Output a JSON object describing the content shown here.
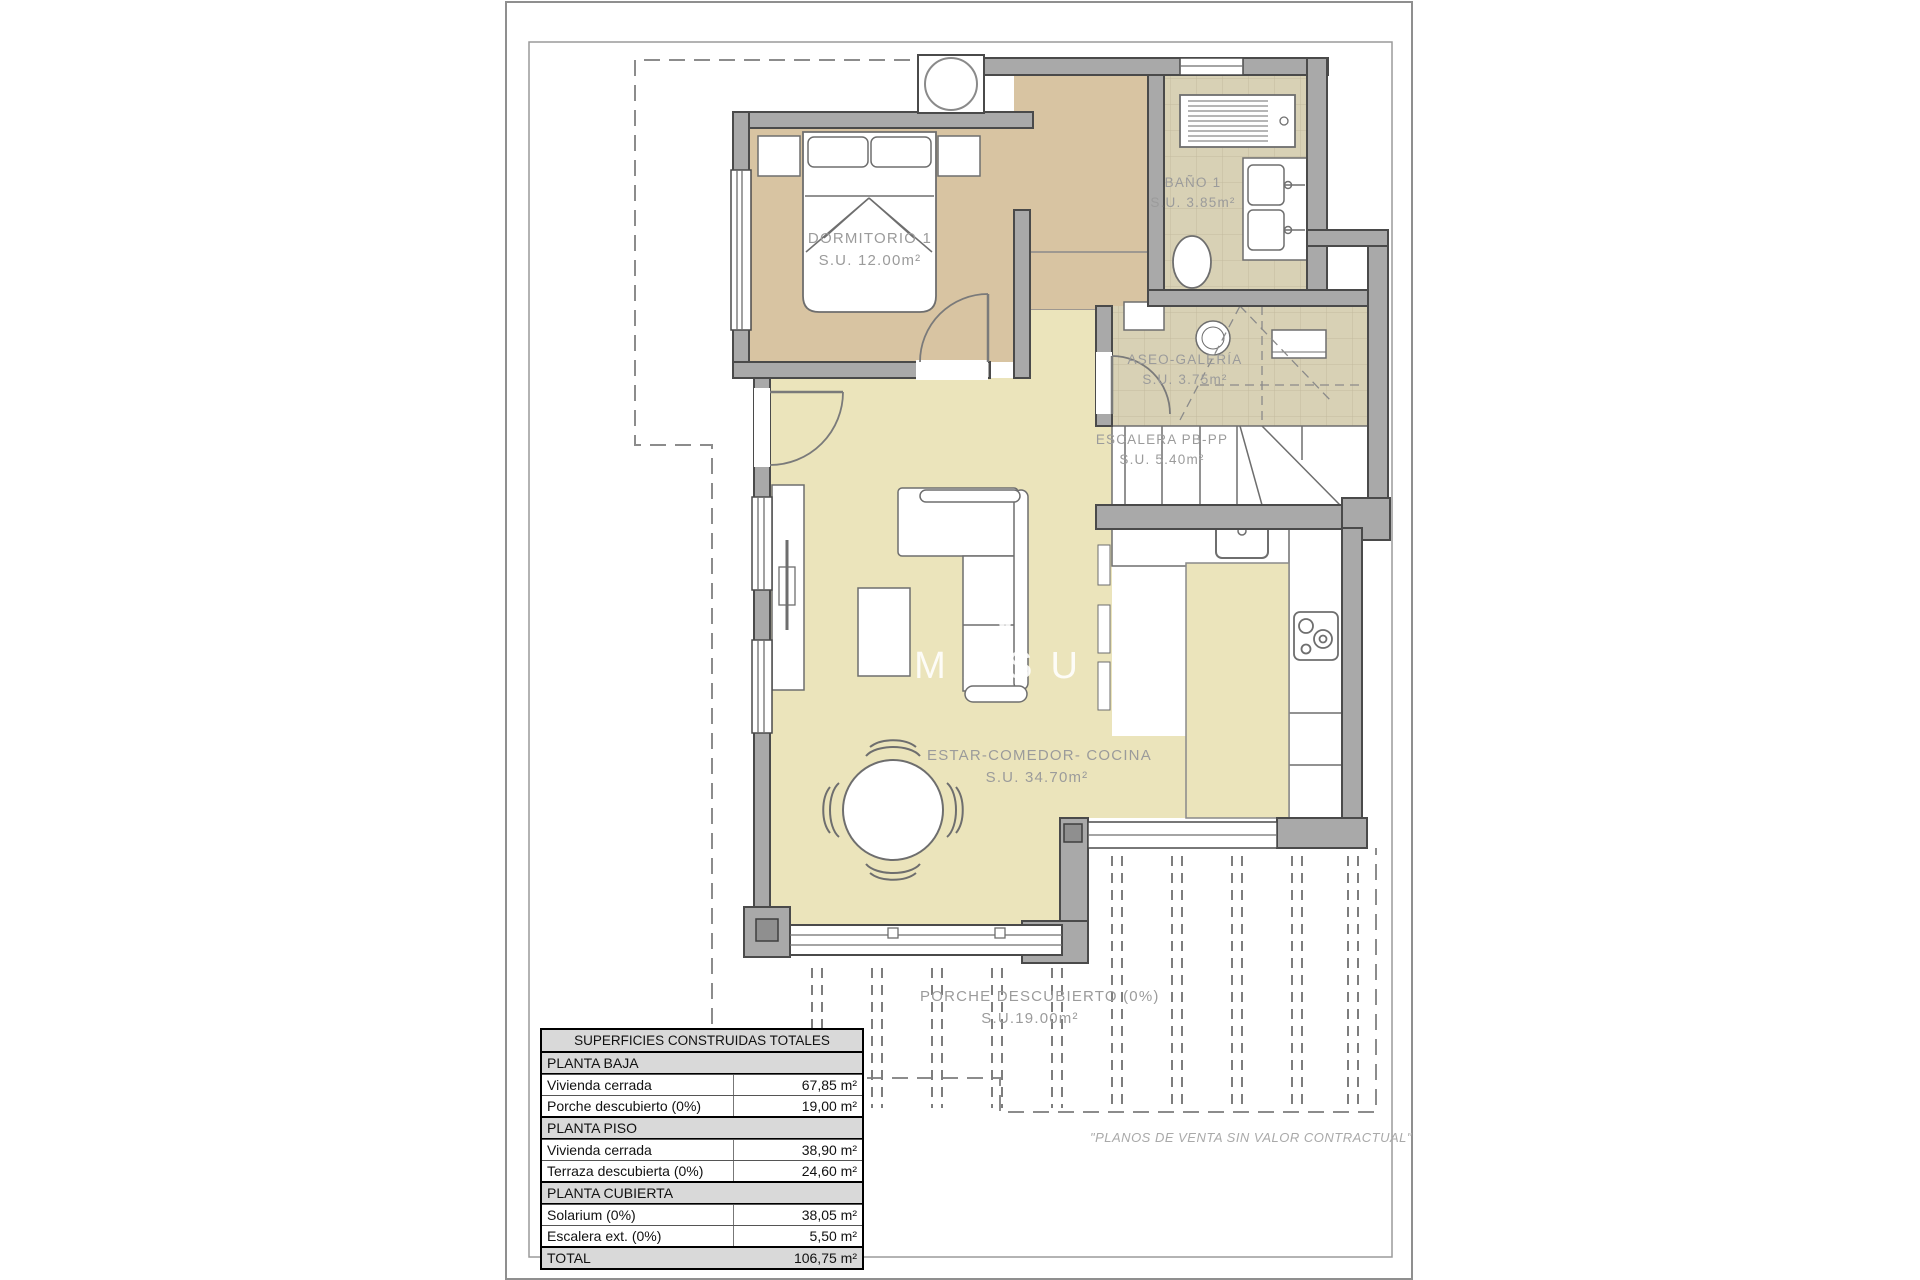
{
  "document": {
    "type": "floor-plan",
    "disclaimer": "\"PLANOS DE VENTA SIN VALOR CONTRACTUAL\""
  },
  "watermark": {
    "letters": "MASU"
  },
  "rooms": {
    "dormitorio": {
      "name": "DORMITORIO 1",
      "area": "S.U. 12.00m²"
    },
    "bano": {
      "name": "BAÑO 1",
      "area": "S.U. 3.85m²"
    },
    "aseo": {
      "name": "ASEO-GALERÍA",
      "area": "S.U. 3.75m²"
    },
    "escalera": {
      "name": "ESCALERA PB-PP",
      "area": "S.U. 5.40m²"
    },
    "estar": {
      "name": "ESTAR-COMEDOR- COCINA",
      "area": "S.U. 34.70m²"
    },
    "porche": {
      "name": "PORCHE DESCUBIERTO (0%)",
      "area": "S.U.19.00m²"
    }
  },
  "table": {
    "title": "SUPERFICIES CONSTRUIDAS TOTALES",
    "rows": [
      {
        "type": "section",
        "label": "PLANTA BAJA"
      },
      {
        "type": "data",
        "label": "Vivienda cerrada",
        "value": "67,85 m²"
      },
      {
        "type": "data",
        "label": "Porche descubierto (0%)",
        "value": "19,00 m²"
      },
      {
        "type": "section",
        "label": "PLANTA PISO"
      },
      {
        "type": "data",
        "label": "Vivienda cerrada",
        "value": "38,90 m²"
      },
      {
        "type": "data",
        "label": "Terraza descubierta (0%)",
        "value": "24,60 m²"
      },
      {
        "type": "section",
        "label": "PLANTA CUBIERTA"
      },
      {
        "type": "data",
        "label": "Solarium (0%)",
        "value": "38,05 m²"
      },
      {
        "type": "data",
        "label": "Escalera ext. (0%)",
        "value": "5,50 m²"
      },
      {
        "type": "total",
        "label": "TOTAL",
        "value": "106,75 m²"
      }
    ]
  },
  "colors": {
    "wall_gray": "#a9a9a9",
    "wall_outline": "#4a4a4a",
    "bedroom_floor_tan": "#d8c4a2",
    "living_floor_khaki": "#ebe4bb",
    "bath_tile_beige": "#d8d1b5",
    "label_gray": "#9b9b9b"
  }
}
